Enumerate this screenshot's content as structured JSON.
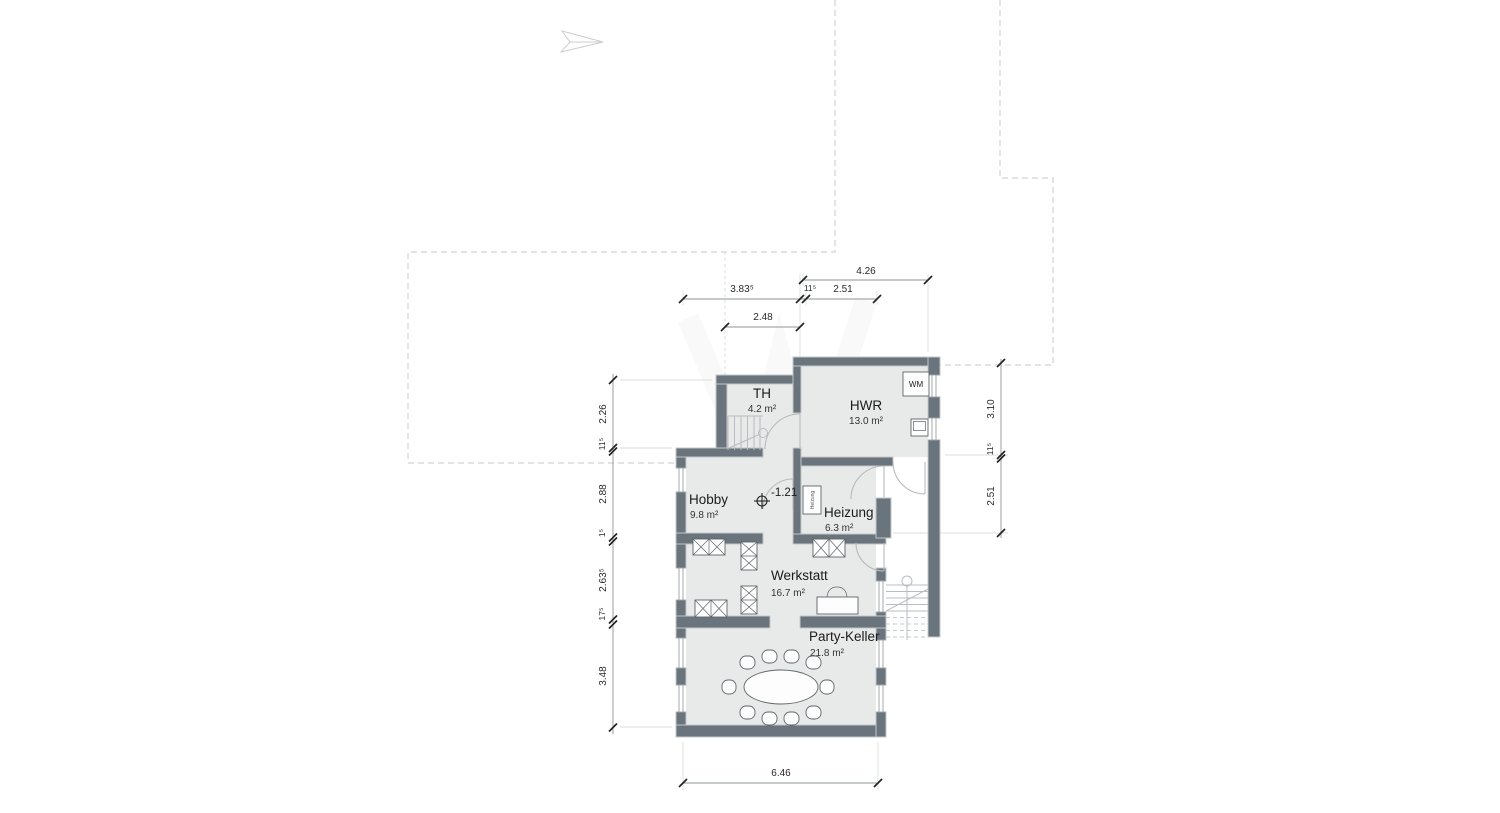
{
  "plan": {
    "rooms": [
      {
        "name": "TH",
        "area": "4.2 m²"
      },
      {
        "name": "HWR",
        "area": "13.0 m²"
      },
      {
        "name": "Hobby",
        "area": "9.8 m²"
      },
      {
        "name": "Heizung",
        "area": "6.3 m²"
      },
      {
        "name": "Werkstatt",
        "area": "16.7 m²"
      },
      {
        "name": "Party-Keller",
        "area": "21.8 m²"
      }
    ],
    "annotations": {
      "level": "-1.21",
      "washing_machine": "WM",
      "boiler": "Heizung"
    },
    "dimensions": {
      "top": [
        "4.26",
        "3.83⁵",
        "11⁵",
        "2.51",
        "2.48"
      ],
      "left": [
        "2.26",
        "11⁵",
        "2.88",
        "1⁵",
        "2.63⁵",
        "17⁵",
        "3.48"
      ],
      "right": [
        "3.10",
        "11⁵",
        "2.51"
      ],
      "bottom": [
        "6.46"
      ]
    },
    "colors": {
      "wall": "#6a747c",
      "floor": "#e8e9e9",
      "dashed_outline": "#cfd2d4",
      "dimension_text": "#2a2a2a"
    }
  }
}
